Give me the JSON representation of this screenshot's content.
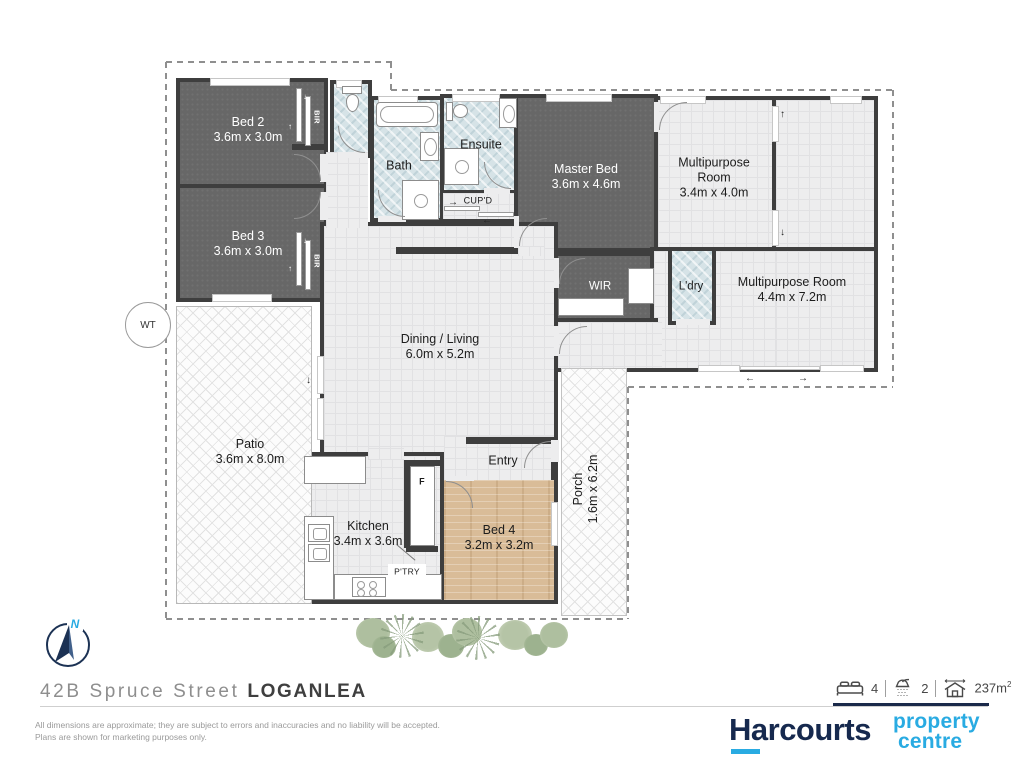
{
  "plan": {
    "rooms": {
      "bed2": {
        "name": "Bed 2",
        "dims": "3.6m x 3.0m"
      },
      "bed3": {
        "name": "Bed 3",
        "dims": "3.6m x 3.0m"
      },
      "bath": {
        "name": "Bath"
      },
      "ensuite": {
        "name": "Ensuite"
      },
      "master": {
        "name": "Master Bed",
        "dims": "3.6m x 4.6m"
      },
      "multi1": {
        "line1": "Multipurpose",
        "line2": "Room",
        "dims": "3.4m x 4.0m"
      },
      "multi2": {
        "name": "Multipurpose Room",
        "dims": "4.4m x 7.2m"
      },
      "dining": {
        "name": "Dining / Living",
        "dims": "6.0m x 5.2m"
      },
      "patio": {
        "name": "Patio",
        "dims": "3.6m x 8.0m"
      },
      "kitchen": {
        "name": "Kitchen",
        "dims": "3.4m x 3.6m"
      },
      "bed4": {
        "name": "Bed 4",
        "dims": "3.2m x 3.2m"
      },
      "porch": {
        "name": "Porch",
        "dims": "1.6m x 6.2m"
      },
      "entry": {
        "name": "Entry"
      },
      "wir": {
        "name": "WIR"
      },
      "ldry": {
        "name": "L'dry"
      }
    },
    "features": {
      "bir": "BIR",
      "cupd": "CUP'D",
      "fridge": "F",
      "pantry": "P'TRY",
      "water_tank": "WT"
    },
    "compass_north": "N"
  },
  "footer": {
    "address_street": "42B Spruce Street",
    "address_suburb": "LOGANLEA",
    "stats": {
      "beds": "4",
      "baths": "2",
      "area_value": "237m",
      "area_sup": "2"
    },
    "disclaimer_line1": "All dimensions are approximate; they are subject to errors and inaccuracies and no liability will be accepted.",
    "disclaimer_line2": "Plans are shown for marketing purposes only.",
    "logo": {
      "brand": "Harcourts",
      "sub_line1": "property",
      "sub_line2": "centre"
    }
  },
  "colors": {
    "brand_navy": "#16294e",
    "brand_cyan": "#29abe2",
    "wall": "#3e3e3e"
  }
}
